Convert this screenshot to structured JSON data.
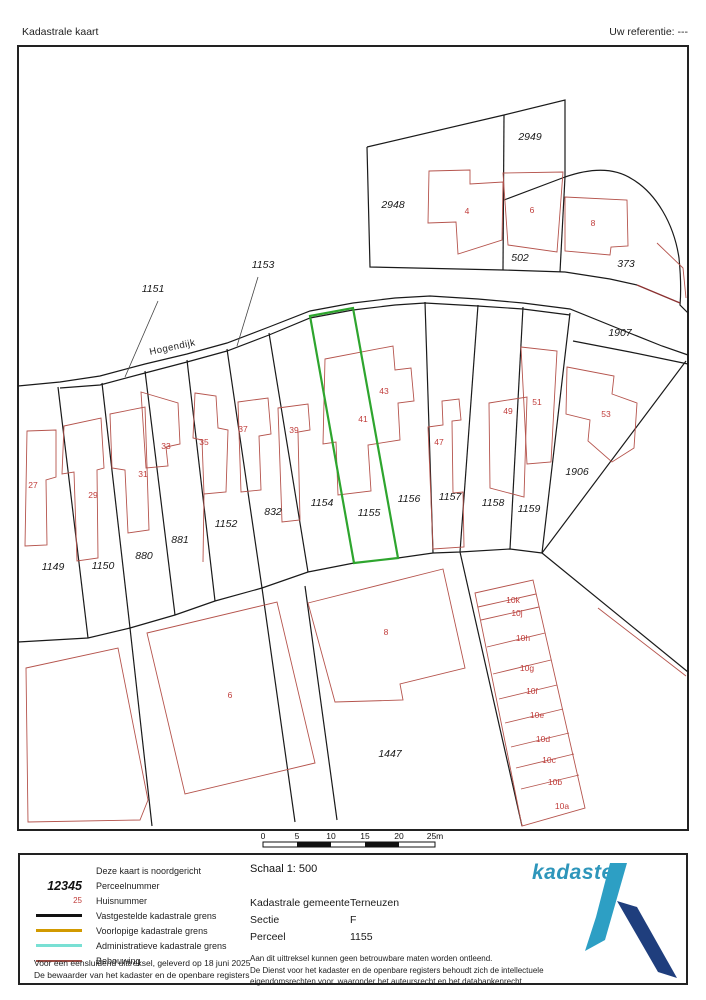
{
  "header": {
    "title": "Kadastrale kaart",
    "reference": "Uw referentie: ---"
  },
  "map": {
    "street": {
      "t": "Hogendijk",
      "x": 173,
      "y": 350,
      "rot": -12
    },
    "highlight_color": "#2ea52e",
    "building_color": "#b5544d",
    "boundary_color": "#1a1a1a",
    "parcel_labels": [
      {
        "t": "2948",
        "x": 393,
        "y": 208
      },
      {
        "t": "2949",
        "x": 530,
        "y": 140
      },
      {
        "t": "502",
        "x": 520,
        "y": 261
      },
      {
        "t": "373",
        "x": 626,
        "y": 267
      },
      {
        "t": "1907",
        "x": 620,
        "y": 336
      },
      {
        "t": "1906",
        "x": 577,
        "y": 475
      },
      {
        "t": "1151",
        "x": 153,
        "y": 292
      },
      {
        "t": "1153",
        "x": 263,
        "y": 268
      },
      {
        "t": "1149",
        "x": 53,
        "y": 570
      },
      {
        "t": "1150",
        "x": 103,
        "y": 569
      },
      {
        "t": "880",
        "x": 144,
        "y": 559
      },
      {
        "t": "881",
        "x": 180,
        "y": 543
      },
      {
        "t": "1152",
        "x": 226,
        "y": 527
      },
      {
        "t": "832",
        "x": 273,
        "y": 515
      },
      {
        "t": "1154",
        "x": 322,
        "y": 506
      },
      {
        "t": "1155",
        "x": 369,
        "y": 516
      },
      {
        "t": "1156",
        "x": 409,
        "y": 502
      },
      {
        "t": "1157",
        "x": 450,
        "y": 500
      },
      {
        "t": "1158",
        "x": 493,
        "y": 506
      },
      {
        "t": "1159",
        "x": 529,
        "y": 512
      },
      {
        "t": "1447",
        "x": 390,
        "y": 757
      }
    ],
    "house_labels": [
      {
        "t": "4",
        "x": 467,
        "y": 214
      },
      {
        "t": "6",
        "x": 532,
        "y": 213
      },
      {
        "t": "8",
        "x": 593,
        "y": 226
      },
      {
        "t": "27",
        "x": 33,
        "y": 488
      },
      {
        "t": "29",
        "x": 93,
        "y": 498
      },
      {
        "t": "31",
        "x": 143,
        "y": 477
      },
      {
        "t": "33",
        "x": 166,
        "y": 449
      },
      {
        "t": "35",
        "x": 204,
        "y": 445
      },
      {
        "t": "37",
        "x": 243,
        "y": 432
      },
      {
        "t": "39",
        "x": 294,
        "y": 433
      },
      {
        "t": "41",
        "x": 363,
        "y": 422
      },
      {
        "t": "43",
        "x": 384,
        "y": 394
      },
      {
        "t": "47",
        "x": 439,
        "y": 445
      },
      {
        "t": "49",
        "x": 508,
        "y": 414
      },
      {
        "t": "51",
        "x": 537,
        "y": 405
      },
      {
        "t": "53",
        "x": 606,
        "y": 417
      },
      {
        "t": "6",
        "x": 230,
        "y": 698
      },
      {
        "t": "8",
        "x": 386,
        "y": 635
      },
      {
        "t": "10k",
        "x": 513,
        "y": 603
      },
      {
        "t": "10j",
        "x": 517,
        "y": 616
      },
      {
        "t": "10h",
        "x": 523,
        "y": 641
      },
      {
        "t": "10g",
        "x": 527,
        "y": 671
      },
      {
        "t": "10f",
        "x": 532,
        "y": 694
      },
      {
        "t": "10e",
        "x": 537,
        "y": 718
      },
      {
        "t": "10d",
        "x": 543,
        "y": 742
      },
      {
        "t": "10c",
        "x": 549,
        "y": 763
      },
      {
        "t": "10b",
        "x": 555,
        "y": 785
      },
      {
        "t": "10a",
        "x": 562,
        "y": 809
      }
    ]
  },
  "scale_bar": {
    "ticks": [
      {
        "t": "0",
        "x": 263
      },
      {
        "t": "5",
        "x": 297
      },
      {
        "t": "10",
        "x": 331
      },
      {
        "t": "15",
        "x": 365
      },
      {
        "t": "20",
        "x": 399
      },
      {
        "t": "25m",
        "x": 435
      }
    ]
  },
  "legend": {
    "north_note": "Deze kaart is noordgericht",
    "items": [
      {
        "sample": "12345",
        "label": "Perceelnummer"
      },
      {
        "sample": "25",
        "label": "Huisnummer"
      },
      {
        "label": "Vastgestelde kadastrale grens",
        "color": "#111111"
      },
      {
        "label": "Voorlopige kadastrale grens",
        "color": "#d29a00"
      },
      {
        "label": "Administratieve kadastrale grens",
        "color": "#79e0d4"
      },
      {
        "label": "Bebouwing",
        "color": "#9c4a42"
      }
    ],
    "note_line1": "Voor een eensluidend uittreksel, geleverd op 18 juni 2025",
    "note_line2": "De bewaarder van het kadaster en de openbare registers"
  },
  "info": {
    "scale": "Schaal 1: 500",
    "fields": [
      {
        "label": "Kadastrale gemeente",
        "value": "Terneuzen"
      },
      {
        "label": "Sectie",
        "value": "F"
      },
      {
        "label": "Perceel",
        "value": "1155"
      }
    ],
    "disclaimer": [
      "Aan dit uittreksel kunnen geen betrouwbare maten worden ontleend.",
      "De Dienst voor het kadaster en de openbare registers behoudt zich de intellectuele",
      "eigendomsrechten voor, waaronder het auteursrecht en het databankenrecht."
    ]
  },
  "logo": {
    "text": "kadaster",
    "text_color": "#2e96bb",
    "light": "#2d9fc4",
    "dark": "#1f3e7d"
  }
}
